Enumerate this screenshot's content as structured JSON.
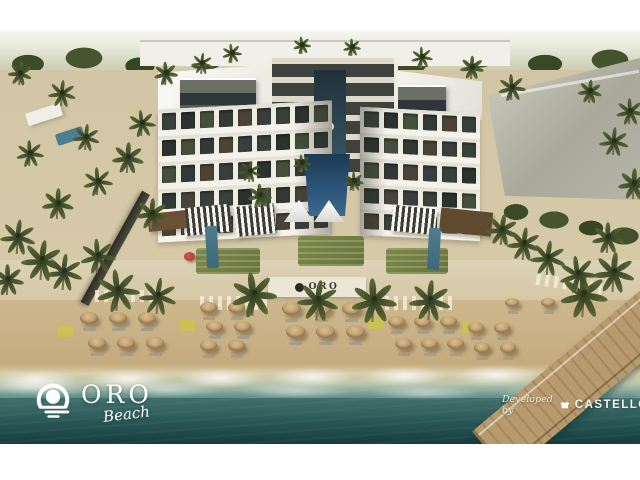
{
  "meta": {
    "description": "Aerial architectural rendering of a U-shaped beachfront resort with central pool courtyard, beach club, umbrella-lined sand beach, ocean and boardwalk pier",
    "image_type": "architectural-rendering"
  },
  "branding": {
    "wordmark": "ORO",
    "tagline": "Beach",
    "icon": "sun-over-waves-icon"
  },
  "developer": {
    "prefix": "Developed by",
    "name": "CASTELLO",
    "icon": "castle-icon"
  },
  "scene": {
    "wall_sign": {
      "text": "ORO"
    },
    "palette": {
      "sky_white": "#f7f8f2",
      "tree_green": "#46552e",
      "sand": "#c9b289",
      "building_white": "#efece2",
      "roof_gray": "#5a5e58",
      "neighbor_gray": "#b4b4a6",
      "pool_blue": "#2c567a",
      "lawn_green": "#7e8a49",
      "umbrella_straw": "#c3a376",
      "ocean_teal": "#1d4847",
      "wood_pier": "#b79a6d",
      "accent_red": "#b5443c"
    },
    "window_colors": [
      "#39413a",
      "#2c332f",
      "#454f3c",
      "#333a35",
      "#4a4438",
      "#3a3f3d"
    ],
    "wings": [
      {
        "x": 158,
        "y": 75,
        "w": 174,
        "h": 133,
        "skew": -3,
        "floors": 5,
        "cols": 9
      },
      {
        "x": 360,
        "y": 80,
        "w": 120,
        "h": 128,
        "skew": 3,
        "floors": 5,
        "cols": 6
      }
    ],
    "umbrella_clusters": [
      {
        "x": 80,
        "y": 282,
        "cols": 3,
        "rows": 2,
        "dx": 29,
        "dy": 25,
        "stagger": 8,
        "size": 18
      },
      {
        "x": 200,
        "y": 272,
        "cols": 2,
        "rows": 3,
        "dx": 28,
        "dy": 19,
        "stagger": 6,
        "size": 17
      },
      {
        "x": 282,
        "y": 272,
        "cols": 3,
        "rows": 2,
        "dx": 30,
        "dy": 23,
        "stagger": 4,
        "size": 19
      },
      {
        "x": 388,
        "y": 286,
        "cols": 3,
        "rows": 2,
        "dx": 26,
        "dy": 22,
        "stagger": 7,
        "size": 17
      },
      {
        "x": 468,
        "y": 292,
        "cols": 2,
        "rows": 2,
        "dx": 26,
        "dy": 20,
        "stagger": 6,
        "size": 16
      },
      {
        "x": 505,
        "y": 268,
        "cols": 2,
        "rows": 1,
        "dx": 36,
        "dy": 0,
        "stagger": 0,
        "size": 14
      }
    ],
    "palms": [
      [
        18,
        205,
        34
      ],
      [
        42,
        228,
        40
      ],
      [
        8,
        248,
        30
      ],
      [
        64,
        240,
        36
      ],
      [
        98,
        224,
        34
      ],
      [
        58,
        172,
        30
      ],
      [
        98,
        150,
        28
      ],
      [
        128,
        126,
        30
      ],
      [
        86,
        106,
        26
      ],
      [
        142,
        92,
        26
      ],
      [
        30,
        122,
        26
      ],
      [
        152,
        182,
        30
      ],
      [
        118,
        258,
        42
      ],
      [
        158,
        264,
        36
      ],
      [
        254,
        262,
        44
      ],
      [
        318,
        268,
        40
      ],
      [
        374,
        268,
        44
      ],
      [
        430,
        268,
        40
      ],
      [
        584,
        262,
        46
      ],
      [
        614,
        240,
        40
      ],
      [
        502,
        198,
        30
      ],
      [
        524,
        212,
        32
      ],
      [
        548,
        226,
        34
      ],
      [
        578,
        242,
        36
      ],
      [
        608,
        206,
        30
      ],
      [
        634,
        152,
        30
      ],
      [
        614,
        110,
        28
      ],
      [
        250,
        140,
        22
      ],
      [
        260,
        164,
        24
      ],
      [
        302,
        132,
        18
      ],
      [
        354,
        150,
        20
      ],
      [
        166,
        42,
        24
      ],
      [
        202,
        32,
        22
      ],
      [
        62,
        62,
        26
      ],
      [
        20,
        42,
        24
      ],
      [
        232,
        22,
        20
      ],
      [
        422,
        26,
        22
      ],
      [
        472,
        36,
        24
      ],
      [
        512,
        56,
        26
      ],
      [
        302,
        14,
        18
      ],
      [
        352,
        16,
        18
      ],
      [
        590,
        60,
        24
      ],
      [
        630,
        80,
        26
      ]
    ]
  }
}
